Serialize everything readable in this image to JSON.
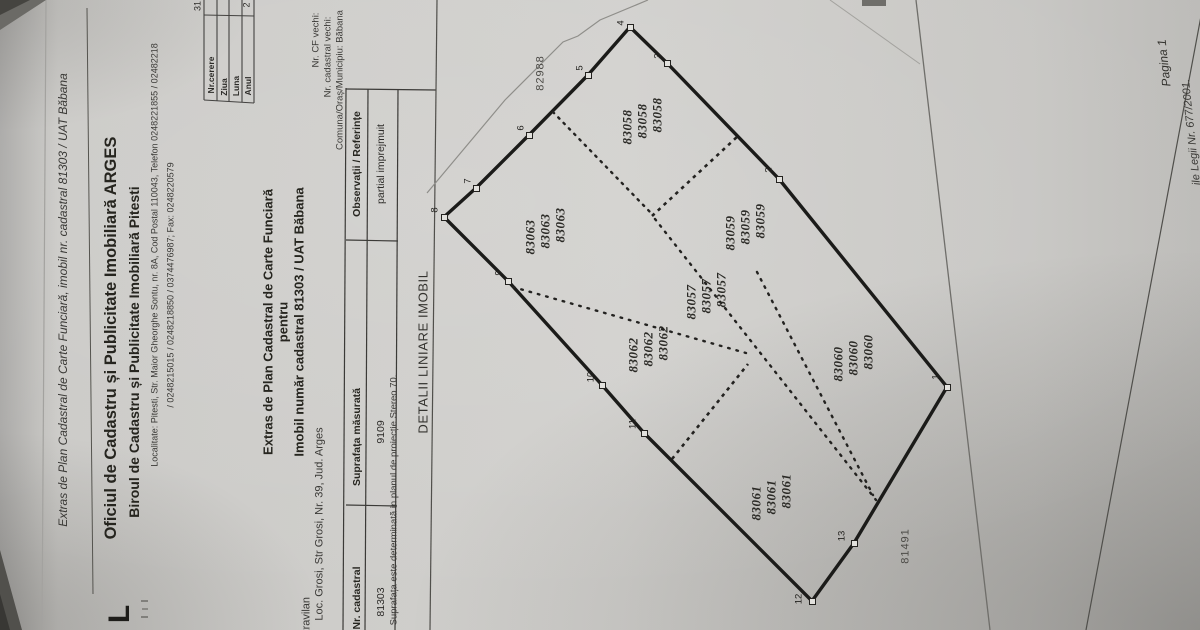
{
  "colors": {
    "paper": "#cecdc9",
    "ink": "#26251f",
    "heavy_line": "#1b1b19",
    "thin_line": "#7e7d7a"
  },
  "header": {
    "doc_ref_line": "Extras de Plan Cadastral de Carte Funciară, imobil nr. cadastral 81303 / UAT Băbana",
    "office_line1": "Oficiul de Cadastru și Publicitate Imobiliară ARGES",
    "office_line2": "Biroul de Cadastru și Publicitate Imobiliară Pitesti",
    "address_line1": "Localitate: Pitesti, Str. Maior Gheorghe Sontu, nr. 8A, Cod Postal 110043, Telefon 0248221855 / 02482218",
    "address_line2": "/ 0248215015 / 0248218850 / 0374476987; Fax: 0248220579",
    "logo_glyph": "L"
  },
  "request_table": {
    "rows": [
      {
        "label": "Nr.cerere",
        "value": "31"
      },
      {
        "label": "Ziua",
        "value": ""
      },
      {
        "label": "Luna",
        "value": ""
      },
      {
        "label": "Anul",
        "value": "2"
      }
    ]
  },
  "reference": {
    "cf_vechi_label": "Nr. CF vechi:",
    "cadastral_vechi_label": "Nr. cadastral vechi:",
    "comuna_label": "Comuna/Oraș/Municipiu: Băbana"
  },
  "title_block": {
    "line1": "Extras de Plan Cadastral de Carte Funciară",
    "line2": "pentru",
    "line3": "Imobil număr cadastral 81303 / UAT Băbana"
  },
  "property": {
    "zone": "intravilan",
    "address": "Loc. Grosi, Str Grosi, Nr. 39, Jud. Arges"
  },
  "main_table": {
    "col1_header": "Nr. cadastral",
    "col2_header": "Suprafața măsurată",
    "col3_header": "Observații / Referințe",
    "row": {
      "nr_cadastral": "81303",
      "suprafata": "9109",
      "observatii": "partial imprejmuit"
    }
  },
  "note": "Suprafața este determinată in planul de proiecție Stereo 70.",
  "section_label": "DETALII LINIARE IMOBIL",
  "plan": {
    "parcels": [
      {
        "number": "83058",
        "x": 642,
        "y": 121
      },
      {
        "number": "83063",
        "x": 545,
        "y": 231
      },
      {
        "number": "83059",
        "x": 745,
        "y": 227
      },
      {
        "number": "83057",
        "x": 706,
        "y": 296
      },
      {
        "number": "83062",
        "x": 648,
        "y": 349
      },
      {
        "number": "83060",
        "x": 853,
        "y": 358
      },
      {
        "number": "83061",
        "x": 771,
        "y": 497
      }
    ],
    "vertices": [
      {
        "n": "1",
        "x": 947,
        "y": 387,
        "lx": 936,
        "ly": 377
      },
      {
        "n": "2",
        "x": 779,
        "y": 179,
        "lx": 769,
        "ly": 170
      },
      {
        "n": "3",
        "x": 667,
        "y": 63,
        "lx": 658,
        "ly": 56
      },
      {
        "n": "4",
        "x": 630,
        "y": 27,
        "lx": 621,
        "ly": 23
      },
      {
        "n": "5",
        "x": 588,
        "y": 75,
        "lx": 580,
        "ly": 68
      },
      {
        "n": "6",
        "x": 529,
        "y": 135,
        "lx": 521,
        "ly": 128
      },
      {
        "n": "7",
        "x": 476,
        "y": 188,
        "lx": 468,
        "ly": 181
      },
      {
        "n": "8",
        "x": 444,
        "y": 217,
        "lx": 435,
        "ly": 210
      },
      {
        "n": "9",
        "x": 508,
        "y": 281,
        "lx": 499,
        "ly": 273
      },
      {
        "n": "10",
        "x": 602,
        "y": 385,
        "lx": 591,
        "ly": 377
      },
      {
        "n": "11",
        "x": 644,
        "y": 433,
        "lx": 633,
        "ly": 424
      },
      {
        "n": "12",
        "x": 812,
        "y": 601,
        "lx": 799,
        "ly": 599
      },
      {
        "n": "13",
        "x": 854,
        "y": 543,
        "lx": 842,
        "ly": 536
      }
    ],
    "neighbors": [
      {
        "number": "82988",
        "x": 541,
        "y": 73
      },
      {
        "number": "81491",
        "x": 906,
        "y": 546
      }
    ]
  },
  "footer": {
    "page_label": "Pagina 1",
    "legal_text": "ile Legii Nr. 677/2001."
  }
}
